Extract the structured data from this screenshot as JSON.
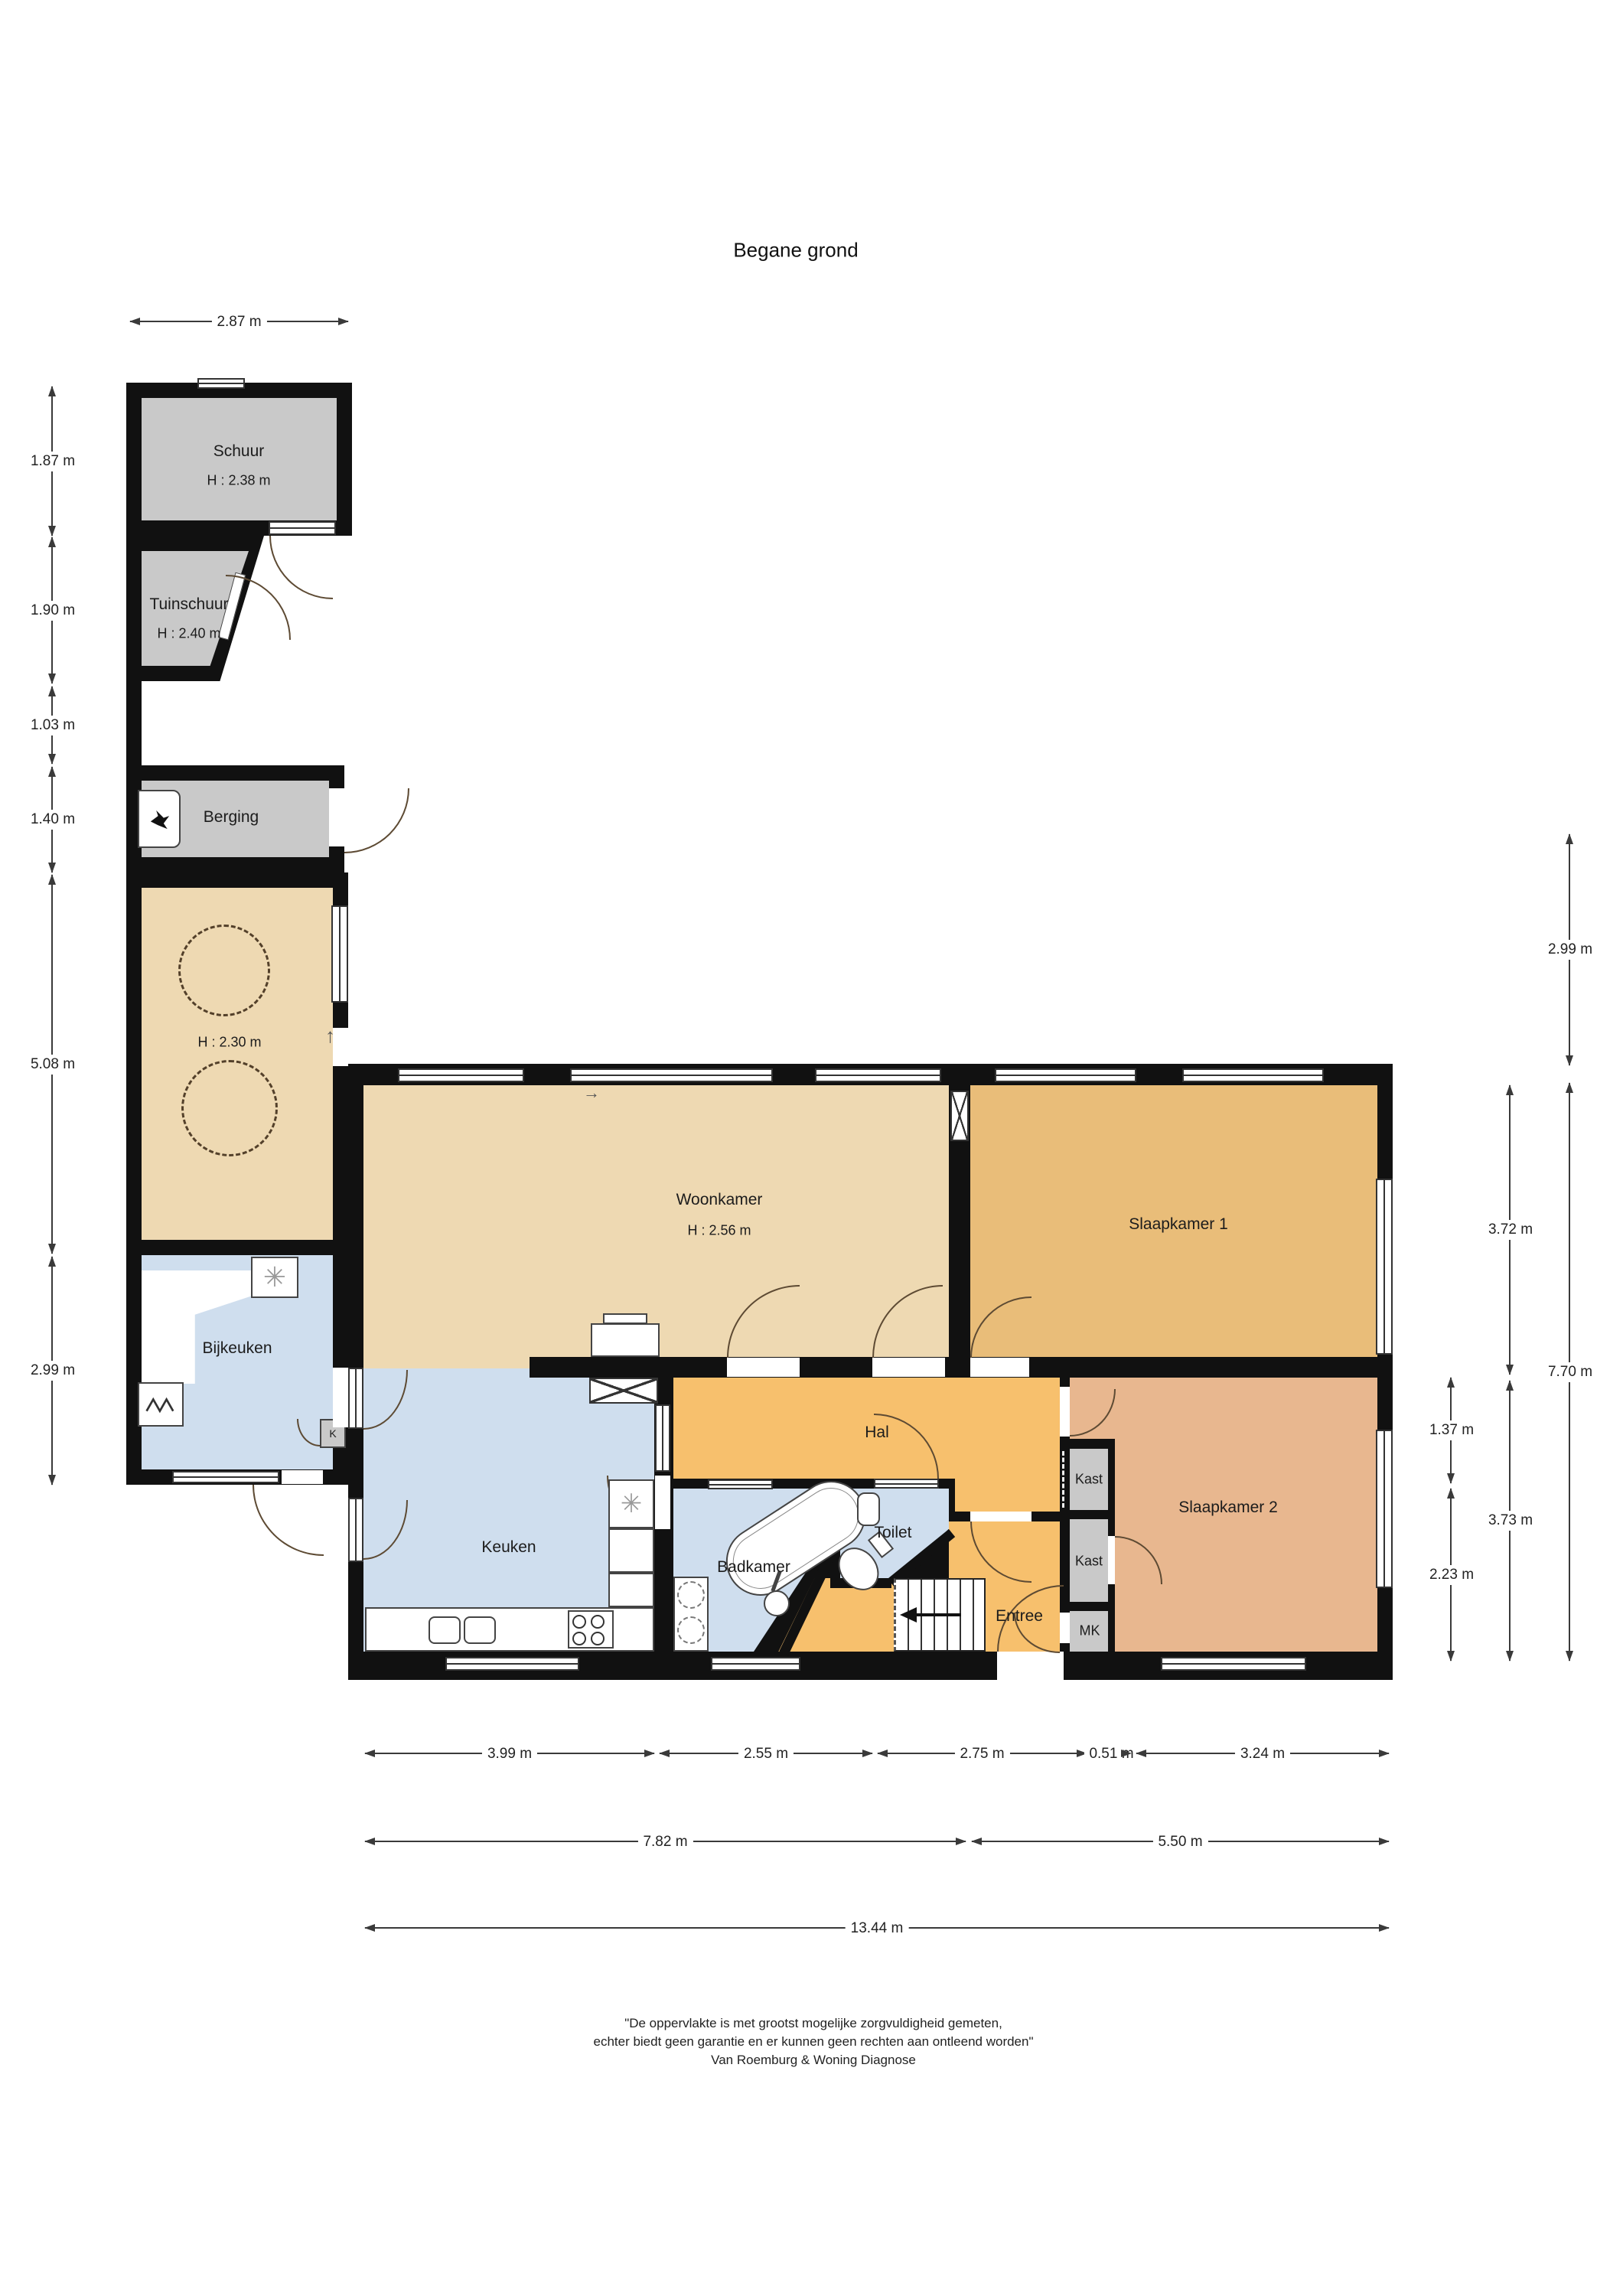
{
  "title": "Begane grond",
  "colors": {
    "wall": "#111111",
    "shed_gray": "#c9c9c9",
    "living_tan": "#eed9b2",
    "bedroom1_amber": "#e9bd79",
    "bedroom2_salmon": "#e8b78f",
    "hall_orange": "#f7c06d",
    "wet_blue": "#cfdeee"
  },
  "rooms": {
    "schuur": {
      "label": "Schuur",
      "height": "H : 2.38 m"
    },
    "tuinschuur": {
      "label": "Tuinschuur",
      "height": "H : 2.40 m"
    },
    "berging": {
      "label": "Berging"
    },
    "garage": {
      "height": "H : 2.30 m"
    },
    "bijkeuken": {
      "label": "Bijkeuken"
    },
    "woonkamer": {
      "label": "Woonkamer",
      "height": "H : 2.56 m"
    },
    "keuken": {
      "label": "Keuken"
    },
    "badkamer": {
      "label": "Badkamer"
    },
    "toilet": {
      "label": "Toilet"
    },
    "hal": {
      "label": "Hal"
    },
    "entree": {
      "label": "Entree"
    },
    "slaapkamer1": {
      "label": "Slaapkamer 1"
    },
    "slaapkamer2": {
      "label": "Slaapkamer 2"
    },
    "kast1": {
      "label": "Kast"
    },
    "kast2": {
      "label": "Kast"
    },
    "mk": {
      "label": "MK"
    },
    "koelkast": {
      "label": "K"
    }
  },
  "dims": {
    "top": "2.87 m",
    "left": [
      "1.87 m",
      "1.90 m",
      "1.03 m",
      "1.40 m",
      "5.08 m",
      "2.99 m"
    ],
    "right_outer": [
      "2.99 m",
      "7.70 m"
    ],
    "right_middle": [
      "3.72 m",
      "3.73 m"
    ],
    "right_inner": [
      "1.37 m",
      "2.23 m"
    ],
    "bottom_row1": [
      "3.99 m",
      "2.55 m",
      "2.75 m",
      "0.51 m",
      "3.24 m"
    ],
    "bottom_row2": [
      "7.82 m",
      "5.50 m"
    ],
    "bottom_row3": [
      "13.44 m"
    ]
  },
  "footer": [
    "\"De oppervlakte is met grootst mogelijke zorgvuldigheid gemeten,",
    "echter biedt geen garantie en er kunnen geen rechten aan ontleend worden\"",
    "Van Roemburg & Woning Diagnose"
  ],
  "icons": {
    "ventilation": "✳",
    "direction_up": "↑",
    "direction_right": "→"
  }
}
